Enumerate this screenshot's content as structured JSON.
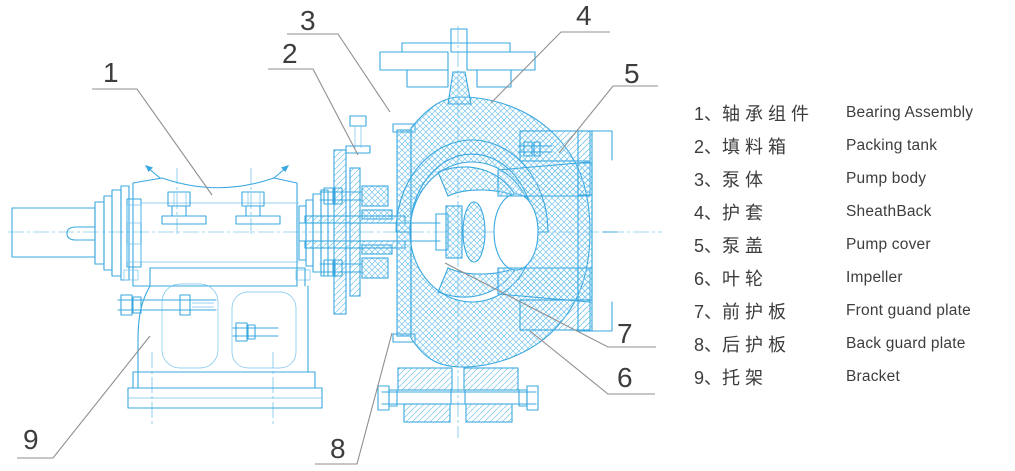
{
  "figure": {
    "type": "technical-sectional-drawing",
    "subject": "Slurry pump cross-section with numbered part callouts",
    "colors": {
      "line_blue": "#3aa8e0",
      "hatch_blue": "#7ac6ec",
      "leader_gray": "#8f8f8f",
      "text_dark": "#3d3d3d",
      "background": "#ffffff"
    }
  },
  "callouts": [
    "1",
    "2",
    "3",
    "4",
    "5",
    "6",
    "7",
    "8",
    "9"
  ],
  "legend": {
    "items": [
      {
        "num": "1、",
        "zh": "轴承组件",
        "en": "Bearing Assembly"
      },
      {
        "num": "2、",
        "zh": "填料箱",
        "en": "Packing tank"
      },
      {
        "num": "3、",
        "zh": "泵体",
        "en": "Pump body"
      },
      {
        "num": "4、",
        "zh": "护套",
        "en": "SheathBack"
      },
      {
        "num": "5、",
        "zh": "泵盖",
        "en": "Pump cover"
      },
      {
        "num": "6、",
        "zh": "叶轮",
        "en": "Impeller"
      },
      {
        "num": "7、",
        "zh": "前护板",
        "en": "Front guand plate"
      },
      {
        "num": "8、",
        "zh": "后护板",
        "en": "Back guard plate"
      },
      {
        "num": "9、",
        "zh": "托架",
        "en": "Bracket"
      }
    ]
  }
}
